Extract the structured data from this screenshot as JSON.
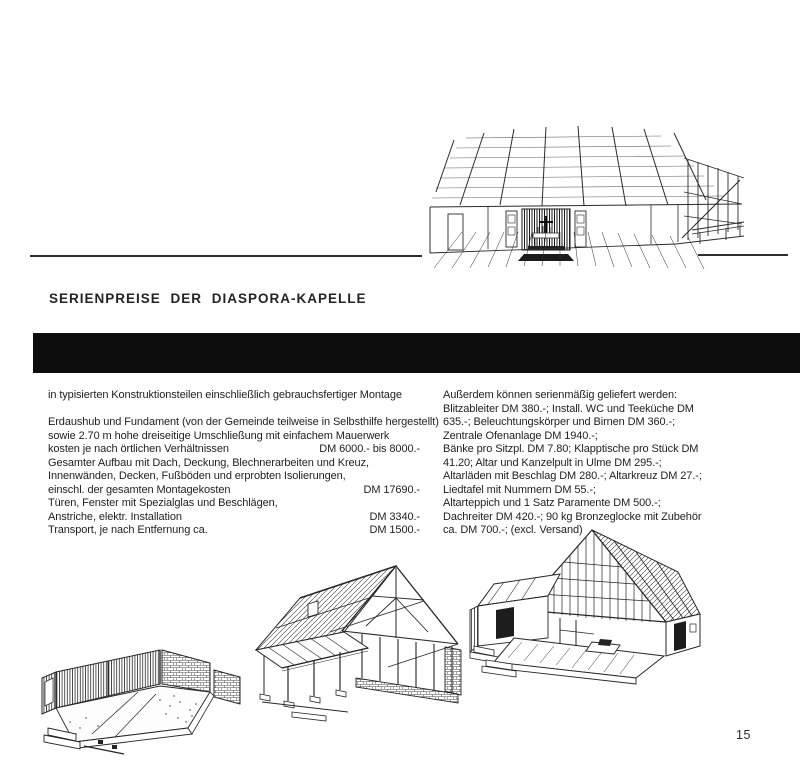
{
  "doc": {
    "page_number": "15",
    "heading": "SERIENPREISE DER DIASPORA-KAPELLE",
    "intro": "in typisierten Konstruktionsteilen einschließlich gebrauchsfertiger Montage",
    "left_column": {
      "lines": [
        {
          "text": "Erdaushub und Fundament (von der Gemeinde teilweise in Selbsthilfe hergestellt)",
          "price": ""
        },
        {
          "text": "sowie 2.70 m hohe dreiseitige Umschließung mit einfachem Mauerwerk",
          "price": ""
        },
        {
          "text": "kosten je nach örtlichen Verhältnissen",
          "price": "DM 6000.- bis 8000.-"
        },
        {
          "text": "Gesamter Aufbau mit Dach, Deckung, Blechnerarbeiten und Kreuz,",
          "price": ""
        },
        {
          "text": "Innenwänden, Decken, Fußböden und erprobten Isolierungen,",
          "price": ""
        },
        {
          "text": "einschl. der gesamten Montagekosten",
          "price": "DM 17690.-"
        },
        {
          "text": "Türen, Fenster mit Spezialglas und Beschlägen,",
          "price": ""
        },
        {
          "text": "Anstriche, elektr. Installation",
          "price": "DM 3340.-"
        },
        {
          "text": "Transport, je nach Entfernung ca.",
          "price": "DM 1500.-"
        }
      ]
    },
    "right_column": {
      "lines": [
        "Außerdem können serienmäßig geliefert werden:",
        "Blitzableiter DM 380.-; Install. WC und Teeküche DM",
        "635.-; Beleuchtungskörper und Birnen DM 360.-;",
        "Zentrale Ofenanlage DM 1940.-;",
        "Bänke pro Sitzpl. DM 7.80; Klapptische pro Stück DM",
        "41.20; Altar und Kanzelpult in Ulme DM 295.-;",
        "Altarläden mit Beschlag DM 280.-; Altarkreuz DM 27.-;",
        "Liedtafel mit Nummern DM 55.-;",
        "Altarteppich und 1 Satz Paramente DM 500.-;",
        "Dachreiter DM 420.-; 90 kg Bronzeglocke mit Zubehör",
        "ca. DM 700.-; (excl. Versand)"
      ]
    },
    "illustrations": {
      "interior_label": "chapel-interior-sketch",
      "stage_labels": [
        "foundation-masonry-stage",
        "timber-frame-stage",
        "enclosed-shell-stage"
      ]
    },
    "colors": {
      "ink": "#1f1f1f",
      "bar": "#0d0d0d",
      "paper": "#ffffff"
    }
  }
}
